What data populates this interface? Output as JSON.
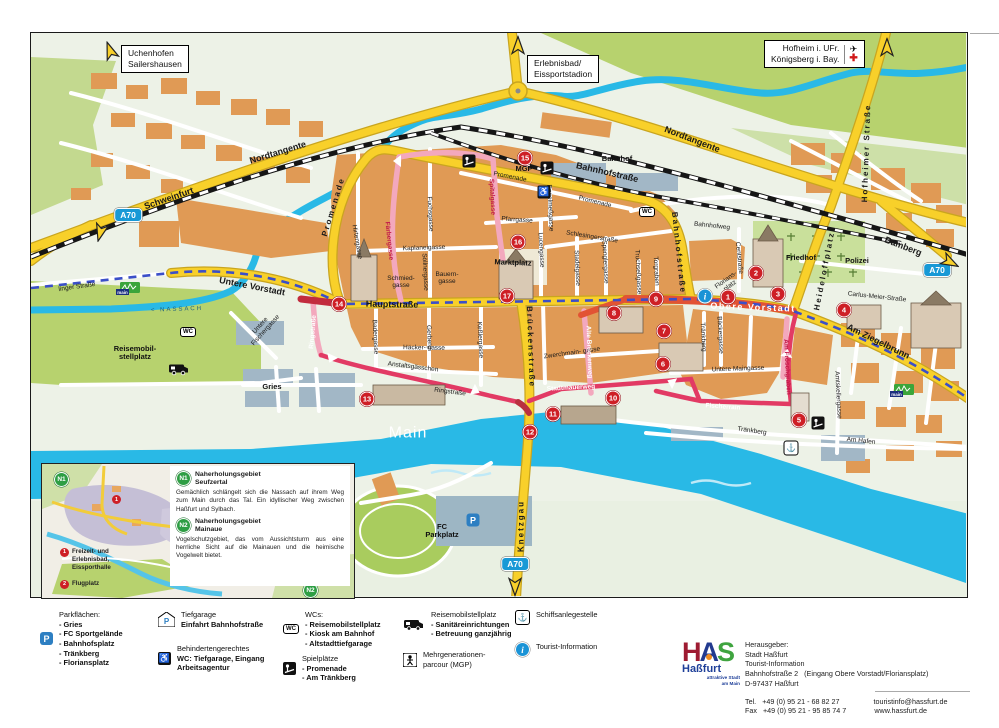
{
  "map": {
    "signs": {
      "uchenhofen": {
        "l1": "Uchenhofen",
        "l2": "Sailershausen"
      },
      "erlebnisbad": {
        "l1": "Erlebnisbad/",
        "l2": "Eissportstadion"
      },
      "hofheim": {
        "l1": "Hofheim i. UFr.",
        "l2": "Königsberg i. Bay."
      }
    },
    "water_labels": {
      "river": "Main",
      "creek": "< NASSACH"
    },
    "streets": [
      {
        "t": "Schweinfurt",
        "x": 168,
        "y": 198,
        "r": -19,
        "c": "ry"
      },
      {
        "t": "Nordtangente",
        "x": 277,
        "y": 152,
        "r": -17,
        "c": "ry"
      },
      {
        "t": "Nordtangente",
        "x": 691,
        "y": 139,
        "r": 21,
        "c": "ry"
      },
      {
        "t": "Bamberg",
        "x": 902,
        "y": 246,
        "r": 21,
        "c": "ry"
      },
      {
        "t": "Hauptstraße",
        "x": 391,
        "y": 304,
        "r": 1,
        "c": "ry"
      },
      {
        "t": "Untere Vorstadt",
        "x": 251,
        "y": 286,
        "r": 11,
        "c": "ry"
      },
      {
        "t": "Obere Vorstadt",
        "x": 752,
        "y": 307,
        "r": 2,
        "c": "ryw"
      },
      {
        "t": "Am Ziegelbrunn",
        "x": 877,
        "y": 341,
        "r": 26,
        "c": "ry"
      },
      {
        "t": "Knetzgau",
        "x": 521,
        "y": 525,
        "r": -90,
        "c": "ryv"
      },
      {
        "t": "Brückenstraße",
        "x": 529,
        "y": 346,
        "r": 88,
        "c": "ryv"
      },
      {
        "t": "Bahnhofstraße",
        "x": 606,
        "y": 172,
        "r": 13,
        "c": "ry"
      },
      {
        "t": "Bahnhofstraße",
        "x": 677,
        "y": 252,
        "r": 84,
        "c": "ryv"
      },
      {
        "t": "Promenade",
        "x": 333,
        "y": 206,
        "r": -73,
        "c": "ryv"
      },
      {
        "t": "Heideloffplatz",
        "x": 824,
        "y": 270,
        "r": -79,
        "c": "ryv"
      },
      {
        "t": "Hofheimer Straße",
        "x": 866,
        "y": 152,
        "r": -88,
        "c": "ryv"
      },
      {
        "t": "linger Straße",
        "x": 76,
        "y": 286,
        "r": -8,
        "c": "st"
      },
      {
        "t": "Bahnhofweg",
        "x": 711,
        "y": 225,
        "r": 6,
        "c": "st"
      },
      {
        "t": "Promenade",
        "x": 509,
        "y": 176,
        "r": 11,
        "c": "st"
      },
      {
        "t": "Promenade",
        "x": 594,
        "y": 201,
        "r": 14,
        "c": "st"
      },
      {
        "t": "Pfarrgasse",
        "x": 516,
        "y": 219,
        "r": 4,
        "c": "st"
      },
      {
        "t": "Kaplaneigasse",
        "x": 423,
        "y": 247,
        "r": -2,
        "c": "st"
      },
      {
        "t": "Fuchsgasse",
        "x": 429,
        "y": 213,
        "r": 87,
        "c": "st"
      },
      {
        "t": "Söllnergasse",
        "x": 424,
        "y": 271,
        "r": 87,
        "c": "st"
      },
      {
        "t": "Hirtengasse",
        "x": 356,
        "y": 241,
        "r": 80,
        "c": "st"
      },
      {
        "t": "Bauern-\ngasse",
        "x": 446,
        "y": 277,
        "r": 0,
        "c": "st"
      },
      {
        "t": "Schmied-\ngasse",
        "x": 400,
        "y": 281,
        "r": 0,
        "c": "st"
      },
      {
        "t": "Lucengasse",
        "x": 540,
        "y": 249,
        "r": 87,
        "c": "st"
      },
      {
        "t": "Schlesingerstraße",
        "x": 591,
        "y": 236,
        "r": 9,
        "c": "st"
      },
      {
        "t": "Stadelgasse",
        "x": 576,
        "y": 267,
        "r": 87,
        "c": "st"
      },
      {
        "t": "Spenglergasse",
        "x": 604,
        "y": 261,
        "r": 87,
        "c": "st"
      },
      {
        "t": "Truchseßgasse",
        "x": 637,
        "y": 271,
        "r": 87,
        "c": "st"
      },
      {
        "t": "Torgraben",
        "x": 655,
        "y": 270,
        "r": 87,
        "c": "st"
      },
      {
        "t": "Engelmeßgasse",
        "x": 549,
        "y": 207,
        "r": 87,
        "c": "st"
      },
      {
        "t": "Centstraße",
        "x": 738,
        "y": 257,
        "r": 84,
        "c": "st"
      },
      {
        "t": "Bäckergasse",
        "x": 719,
        "y": 334,
        "r": 87,
        "c": "st"
      },
      {
        "t": "Tränkberg",
        "x": 702,
        "y": 336,
        "r": 87,
        "c": "st"
      },
      {
        "t": "Tränkberg",
        "x": 751,
        "y": 430,
        "r": 8,
        "c": "st"
      },
      {
        "t": "Florians-\nplatz",
        "x": 727,
        "y": 282,
        "r": -36,
        "c": "st"
      },
      {
        "t": "Carlus-Meier-Straße",
        "x": 876,
        "y": 296,
        "r": 6,
        "c": "st"
      },
      {
        "t": "Am Hafen",
        "x": 860,
        "y": 440,
        "r": 6,
        "c": "st"
      },
      {
        "t": "Amtskellergasse",
        "x": 837,
        "y": 394,
        "r": 87,
        "c": "st"
      },
      {
        "t": "Untere Maingasse",
        "x": 737,
        "y": 368,
        "r": -2,
        "c": "st"
      },
      {
        "t": "Zwerchmain- gasse",
        "x": 571,
        "y": 352,
        "r": -8,
        "c": "st"
      },
      {
        "t": "Häcker-  gasse",
        "x": 423,
        "y": 347,
        "r": 1,
        "c": "st"
      },
      {
        "t": "Gerberg",
        "x": 428,
        "y": 336,
        "r": 87,
        "c": "st"
      },
      {
        "t": "Keßlergasse",
        "x": 479,
        "y": 339,
        "r": 87,
        "c": "st"
      },
      {
        "t": "Badergasse",
        "x": 374,
        "y": 336,
        "r": 87,
        "c": "st"
      },
      {
        "t": "Anstaltsgässchen",
        "x": 412,
        "y": 366,
        "r": 7,
        "c": "st"
      },
      {
        "t": "Ringstraße",
        "x": 449,
        "y": 391,
        "r": 7,
        "c": "st"
      },
      {
        "t": "Untere\nFischergasse",
        "x": 262,
        "y": 327,
        "r": -48,
        "c": "st"
      },
      {
        "t": "Marktplatz",
        "x": 512,
        "y": 262,
        "r": 2,
        "c": "pl"
      },
      {
        "t": "Gries",
        "x": 271,
        "y": 386,
        "r": 0,
        "c": "pl"
      },
      {
        "t": "Bahnhof",
        "x": 616,
        "y": 158,
        "r": 0,
        "c": "pl"
      },
      {
        "t": "Friedhof",
        "x": 800,
        "y": 257,
        "r": 0,
        "c": "pl"
      },
      {
        "t": "Polizei",
        "x": 856,
        "y": 260,
        "r": 0,
        "c": "pl"
      },
      {
        "t": "FC\nParkplatz",
        "x": 441,
        "y": 530,
        "r": 0,
        "c": "pl"
      },
      {
        "t": "MGP",
        "x": 523,
        "y": 168,
        "r": 0,
        "c": "pl"
      },
      {
        "t": "Reisemobil-\nstellplatz",
        "x": 134,
        "y": 352,
        "r": 0,
        "c": "pl"
      },
      {
        "t": "Stadtmauerweg",
        "x": 570,
        "y": 387,
        "r": -3,
        "c": "pw"
      },
      {
        "t": "Fischerrain",
        "x": 722,
        "y": 406,
        "r": 4,
        "c": "pw"
      },
      {
        "t": "Ringstraße",
        "x": 312,
        "y": 331,
        "r": -85,
        "c": "pw"
      },
      {
        "t": "Alte Brückenweg",
        "x": 588,
        "y": 351,
        "r": 88,
        "c": "pw"
      },
      {
        "t": "Spitalgasse",
        "x": 491,
        "y": 196,
        "r": 87,
        "c": "pr"
      },
      {
        "t": "Färbergasse",
        "x": 388,
        "y": 240,
        "r": 84,
        "c": "pr"
      },
      {
        "t": "Am Fröschgraben",
        "x": 786,
        "y": 366,
        "r": 87,
        "c": "pr"
      },
      {
        "t": "Main",
        "x": 407,
        "y": 432,
        "r": 0,
        "c": "wt"
      },
      {
        "t": "< NASSACH",
        "x": 176,
        "y": 309,
        "r": -2,
        "c": "wn"
      }
    ],
    "markers": [
      {
        "n": "1",
        "x": 727,
        "y": 296
      },
      {
        "n": "2",
        "x": 755,
        "y": 272
      },
      {
        "n": "3",
        "x": 777,
        "y": 293
      },
      {
        "n": "4",
        "x": 843,
        "y": 309
      },
      {
        "n": "5",
        "x": 798,
        "y": 419
      },
      {
        "n": "6",
        "x": 662,
        "y": 363
      },
      {
        "n": "7",
        "x": 663,
        "y": 330
      },
      {
        "n": "8",
        "x": 613,
        "y": 312
      },
      {
        "n": "9",
        "x": 655,
        "y": 298
      },
      {
        "n": "10",
        "x": 612,
        "y": 397
      },
      {
        "n": "11",
        "x": 552,
        "y": 413
      },
      {
        "n": "12",
        "x": 529,
        "y": 431
      },
      {
        "n": "13",
        "x": 366,
        "y": 398
      },
      {
        "n": "14",
        "x": 338,
        "y": 303
      },
      {
        "n": "15",
        "x": 524,
        "y": 157
      },
      {
        "n": "16",
        "x": 517,
        "y": 241
      },
      {
        "n": "17",
        "x": 506,
        "y": 295
      }
    ],
    "icons": [
      {
        "t": "wc",
        "x": 646,
        "y": 211
      },
      {
        "t": "wc",
        "x": 187,
        "y": 331
      },
      {
        "t": "pg",
        "x": 468,
        "y": 160
      },
      {
        "t": "pg",
        "x": 546,
        "y": 167
      },
      {
        "t": "pg",
        "x": 817,
        "y": 422
      },
      {
        "t": "ws",
        "x": 543,
        "y": 191
      },
      {
        "t": "info",
        "x": 704,
        "y": 295
      },
      {
        "t": "anchor",
        "x": 790,
        "y": 447
      },
      {
        "t": "camper",
        "x": 178,
        "y": 368
      },
      {
        "t": "pblue",
        "x": 472,
        "y": 519
      },
      {
        "t": "mrw",
        "x": 127,
        "y": 288
      },
      {
        "t": "mrw",
        "x": 901,
        "y": 390
      }
    ],
    "badges": [
      {
        "label": "A70",
        "x": 127,
        "y": 214
      },
      {
        "label": "A70",
        "x": 936,
        "y": 269
      },
      {
        "label": "A70",
        "x": 514,
        "y": 563
      }
    ],
    "arrows": [
      {
        "x": 110,
        "y": 52,
        "r": -20
      },
      {
        "x": 100,
        "y": 229,
        "r": 195
      },
      {
        "x": 517,
        "y": 47,
        "r": 0
      },
      {
        "x": 886,
        "y": 49,
        "r": 0
      },
      {
        "x": 947,
        "y": 260,
        "r": 118
      },
      {
        "x": 514,
        "y": 583,
        "r": 180
      }
    ]
  },
  "inset": {
    "n1": {
      "badge": "N1",
      "title1": "Naherholungsgebiet",
      "title2": "Seufzertal",
      "body": "Gemächlich schlängelt sich die Nassach auf ihrem Weg zum Main durch das Tal. Ein idyl­lischer Weg zwischen Haßfurt und Sylbach."
    },
    "n2": {
      "badge": "N2",
      "title1": "Naherholungsgebiet",
      "title2": "Mainaue",
      "body": "Vogelschutzgebiet, das vom Aussichtsturm aus eine herrliche Sicht auf die Mainauen und die heimische Vogelwelt bietet."
    },
    "key1": {
      "n": "1",
      "label": "Freizeit- und\nErlebnisbad,\nEissporthalle"
    },
    "key2": {
      "n": "2",
      "label": "Flugplatz"
    },
    "map_badge1": "N1",
    "map_badge2": "N2",
    "map_dot1": "1",
    "map_dot2": "2"
  },
  "legend": {
    "col1": {
      "title": "Parkflächen:",
      "items": [
        "- Gries",
        "- FC Sportgelände",
        "- Bahnhofsplatz",
        "- Tränkberg",
        "- Floriansplatz"
      ]
    },
    "col2a": {
      "l1": "Tiefgarage",
      "l2": "Einfahrt Bahnhofstraße"
    },
    "col2b": {
      "l1": "Behindertengerechtes",
      "l2": "WC: Tiefgarage, Eingang",
      "l3": "Arbeitsagentur"
    },
    "col3a": {
      "title": "WCs:",
      "items": [
        "- Reisemobilstellplatz",
        "- Kiosk am Bahnhof",
        "- Altstadttiefgarage"
      ]
    },
    "col3b": {
      "title": "Spielplätze",
      "items": [
        "- Promenade",
        "- Am Tränkberg"
      ]
    },
    "col4a": {
      "title": "Reisemobilstellplatz",
      "items": [
        "- Sanitäreinrichtungen",
        "- Betreuung ganzjährig"
      ]
    },
    "col4b": {
      "l1": "Mehrgenerationen-",
      "l2": "parcour (MGP)"
    },
    "col5a": {
      "label": "Schiffsanlegestelle"
    },
    "col5b": {
      "label": "Tourist-Information"
    }
  },
  "publisher": {
    "logo_h": "H",
    "logo_a": "A",
    "logo_s": "S",
    "logo_city": "Haßfurt",
    "logo_tag1": "attraktive Stadt",
    "logo_tag2": "am Main",
    "label": "Herausgeber:",
    "l1": "Stadt Haßfurt",
    "l2": "Tourist-Information",
    "l3a": "Bahnhofstraße 2",
    "l3b": "(Eingang Obere Vorstadt/Floriansplatz)",
    "l4": "D-97437 Haßfurt",
    "tel_label": "Tel.",
    "tel": "+49 (0) 95 21 - 68 82 27",
    "fax_label": "Fax",
    "fax": "+49 (0) 95 21 - 95 85 74 7",
    "email": "touristinfo@hassfurt.de",
    "web": "www.hassfurt.de"
  },
  "colors": {
    "water": "#29b9e6",
    "road_yellow": "#f8d02a",
    "route_pink": "#e23a64",
    "closed_red": "#e25334",
    "marker_red": "#ce1f26",
    "badge_blue": "#1899d6",
    "green_bright": "#b7d26e",
    "block_orange": "#e09a55"
  }
}
